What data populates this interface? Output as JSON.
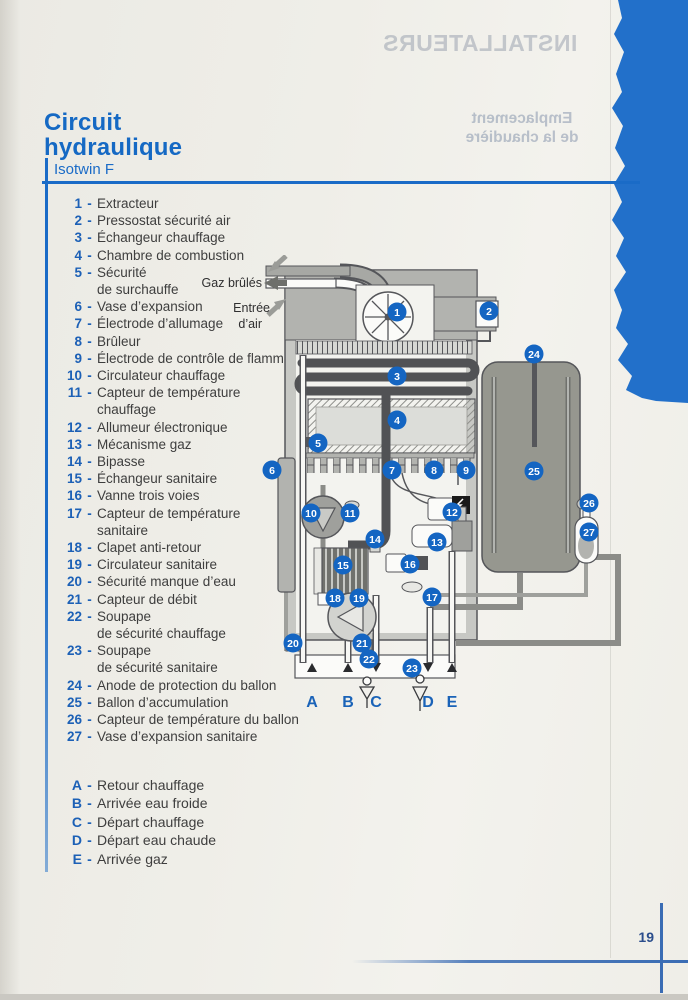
{
  "page": {
    "number": "19"
  },
  "bleed_through": {
    "banner": "INSTALLATEURS",
    "heading_line1": "Emplacement",
    "heading_line2": "de la chaudière",
    "lines": [
      {
        "t": "Déterminer la position de",
        "x": 350,
        "y": 184
      },
      {
        "t": "la chaudière en ayant soin :",
        "x": 350,
        "y": 201
      },
      {
        "t": "De réserver une distance",
        "x": 352,
        "y": 240
      },
      {
        "t": "minimale d’environ",
        "x": 360,
        "y": 257
      },
      {
        "t": "50",
        "x": 212,
        "y": 768,
        "s": 15
      },
      {
        "t": "120",
        "x": 318,
        "y": 831,
        "s": 14
      },
      {
        "t": "600",
        "x": 318,
        "y": 866,
        "s": 14
      }
    ]
  },
  "title": {
    "line1": "Circuit",
    "line2": "hydraulique",
    "subtitle": "Isotwin F"
  },
  "legend": {
    "dash": "-",
    "items": [
      {
        "num": "1",
        "label": "Extracteur"
      },
      {
        "num": "2",
        "label": "Pressostat sécurité air"
      },
      {
        "num": "3",
        "label": "Échangeur chauffage"
      },
      {
        "num": "4",
        "label": "Chambre de combustion"
      },
      {
        "num": "5",
        "label": "Sécurité",
        "label2": "de surchauffe"
      },
      {
        "num": "6",
        "label": "Vase d’expansion"
      },
      {
        "num": "7",
        "label": "Électrode d’allumage"
      },
      {
        "num": "8",
        "label": "Brûleur"
      },
      {
        "num": "9",
        "label": "Électrode de contrôle de flamme"
      },
      {
        "num": "10",
        "label": "Circulateur chauffage"
      },
      {
        "num": "11",
        "label": "Capteur de température",
        "label2": "chauffage"
      },
      {
        "num": "12",
        "label": "Allumeur électronique"
      },
      {
        "num": "13",
        "label": "Mécanisme gaz"
      },
      {
        "num": "14",
        "label": "Bipasse"
      },
      {
        "num": "15",
        "label": "Échangeur sanitaire"
      },
      {
        "num": "16",
        "label": "Vanne trois voies"
      },
      {
        "num": "17",
        "label": "Capteur de température",
        "label2": "sanitaire"
      },
      {
        "num": "18",
        "label": "Clapet anti-retour"
      },
      {
        "num": "19",
        "label": "Circulateur sanitaire"
      },
      {
        "num": "20",
        "label": "Sécurité manque d’eau"
      },
      {
        "num": "21",
        "label": "Capteur de débit"
      },
      {
        "num": "22",
        "label": "Soupape",
        "label2": "de sécurité chauffage"
      },
      {
        "num": "23",
        "label": "Soupape",
        "label2": "de sécurité sanitaire"
      },
      {
        "num": "24",
        "label": "Anode de protection du ballon"
      },
      {
        "num": "25",
        "label": "Ballon d’accumulation"
      },
      {
        "num": "26",
        "label": "Capteur de température du ballon"
      },
      {
        "num": "27",
        "label": "Vase d’expansion sanitaire"
      }
    ]
  },
  "connections": [
    {
      "letter": "A",
      "label": "Retour chauffage"
    },
    {
      "letter": "B",
      "label": "Arrivée eau froide"
    },
    {
      "letter": "C",
      "label": "Départ chauffage"
    },
    {
      "letter": "D",
      "label": "Départ eau chaude"
    },
    {
      "letter": "E",
      "label": "Arrivée gaz"
    }
  ],
  "diagram": {
    "labels": {
      "flue": "Gaz brûlés",
      "air1": "Entrée",
      "air2": "d’air"
    },
    "colors": {
      "callout": "#1465c2"
    },
    "callouts": [
      {
        "n": "1",
        "x": 207,
        "y": 57
      },
      {
        "n": "2",
        "x": 299,
        "y": 56
      },
      {
        "n": "3",
        "x": 207,
        "y": 121
      },
      {
        "n": "4",
        "x": 207,
        "y": 165
      },
      {
        "n": "5",
        "x": 128,
        "y": 188
      },
      {
        "n": "6",
        "x": 82,
        "y": 215
      },
      {
        "n": "7",
        "x": 202,
        "y": 215
      },
      {
        "n": "8",
        "x": 244,
        "y": 215
      },
      {
        "n": "9",
        "x": 276,
        "y": 215
      },
      {
        "n": "10",
        "x": 121,
        "y": 258
      },
      {
        "n": "11",
        "x": 160,
        "y": 258
      },
      {
        "n": "12",
        "x": 262,
        "y": 257
      },
      {
        "n": "13",
        "x": 247,
        "y": 287
      },
      {
        "n": "14",
        "x": 185,
        "y": 284
      },
      {
        "n": "15",
        "x": 153,
        "y": 310
      },
      {
        "n": "16",
        "x": 220,
        "y": 309
      },
      {
        "n": "17",
        "x": 242,
        "y": 342
      },
      {
        "n": "18",
        "x": 145,
        "y": 343
      },
      {
        "n": "19",
        "x": 169,
        "y": 343
      },
      {
        "n": "20",
        "x": 103,
        "y": 388
      },
      {
        "n": "21",
        "x": 172,
        "y": 388
      },
      {
        "n": "22",
        "x": 179,
        "y": 404
      },
      {
        "n": "23",
        "x": 222,
        "y": 413
      },
      {
        "n": "24",
        "x": 344,
        "y": 99
      },
      {
        "n": "25",
        "x": 344,
        "y": 216
      },
      {
        "n": "26",
        "x": 399,
        "y": 248
      },
      {
        "n": "27",
        "x": 399,
        "y": 277
      }
    ],
    "ports": [
      {
        "letter": "A",
        "x": 122,
        "dir": "up"
      },
      {
        "letter": "B",
        "x": 158,
        "dir": "up"
      },
      {
        "letter": "C",
        "x": 186,
        "dir": "down"
      },
      {
        "letter": "D",
        "x": 238,
        "dir": "down"
      },
      {
        "letter": "E",
        "x": 262,
        "dir": "up"
      }
    ]
  }
}
